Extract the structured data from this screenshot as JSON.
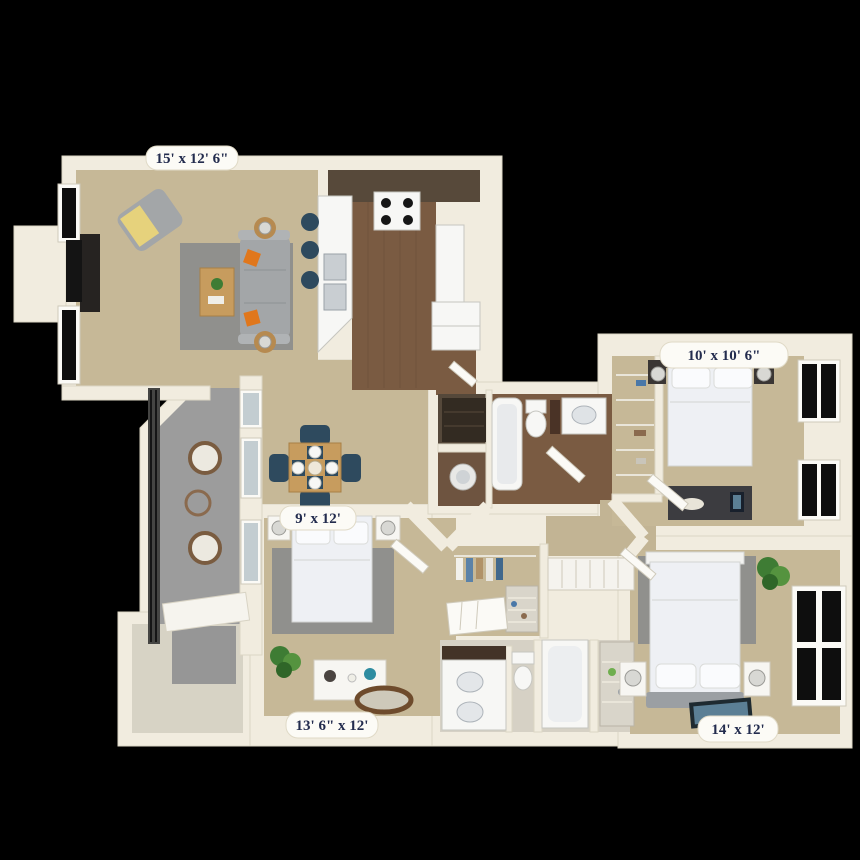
{
  "floorplan": {
    "type": "3d-apartment-floor-plan",
    "background": "#000000",
    "labels": [
      {
        "area": "living-room",
        "text": "15' x 12' 6\""
      },
      {
        "area": "bedroom-top-right",
        "text": "10' x 10' 6\""
      },
      {
        "area": "dining-area",
        "text": "9' x 12'"
      },
      {
        "area": "bedroom-bottom-left",
        "text": "13' 6\" x 12'"
      },
      {
        "area": "bedroom-bottom-right",
        "text": "14' x 12'"
      }
    ],
    "palette": {
      "wall": "#f1ecdf",
      "carpet": "#c6b897",
      "kitchen_wood": "#7a5b42",
      "patio_concrete": "#9c9c9c",
      "area_rug": "#90908d",
      "sofa_gray": "#a3a6a8",
      "accent_orange": "#e0771c",
      "dining_chair_navy": "#2e4a5e",
      "table_oak": "#c79c5e",
      "bedding_white": "#eef0f4",
      "cabinet_brown": "#57493a",
      "glass_dark": "#0e0e0e",
      "plant_green": "#3e7c34",
      "label_pill": "#fcfbf6",
      "label_text_navy": "#232c4e"
    }
  }
}
